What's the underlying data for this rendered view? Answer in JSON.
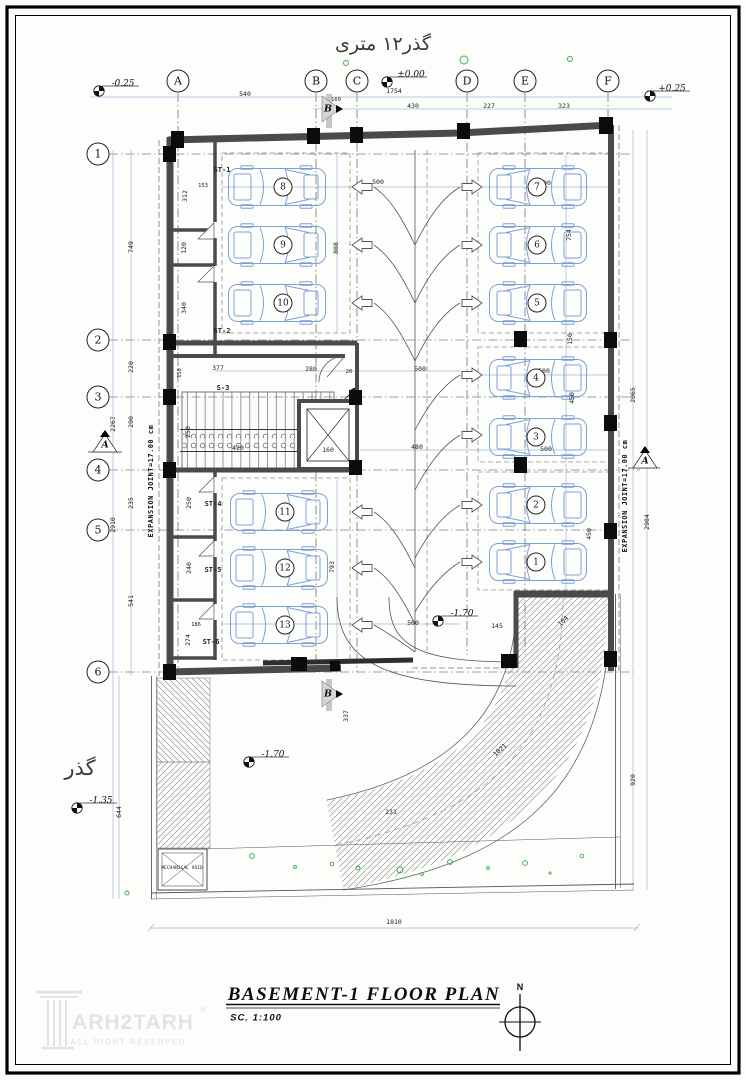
{
  "streets": {
    "top": "گذر۱۲ متری",
    "left": "گذر"
  },
  "grid": {
    "cols": [
      "A",
      "B",
      "C",
      "D",
      "E",
      "F"
    ],
    "rows": [
      "1",
      "2",
      "3",
      "4",
      "5",
      "6"
    ]
  },
  "levels": {
    "top_left": "-0.25",
    "top_center": "±0.00",
    "top_right": "+0.25",
    "aisle": "-1.70",
    "yard": "-1.70",
    "street": "-1.35"
  },
  "dims": {
    "top": [
      "540",
      "160",
      "1754",
      "430",
      "227",
      "323"
    ],
    "left": [
      "749",
      "220",
      "2267",
      "290",
      "235",
      "2910",
      "541",
      "644"
    ],
    "left_inner": [
      "153",
      "312",
      "120",
      "340",
      "150",
      "377",
      "250",
      "420",
      "160",
      "250",
      "240",
      "274",
      "186"
    ],
    "right": [
      "2065",
      "2984",
      "920"
    ],
    "right_inner": [
      "754",
      "150",
      "450",
      "450",
      "164",
      "145"
    ],
    "center": [
      "500",
      "808",
      "500",
      "480",
      "280",
      "20",
      "500",
      "500",
      "500",
      "793",
      "500",
      "337",
      "231",
      "1021"
    ],
    "bottom": "1810"
  },
  "rooms": {
    "st1": "ST-1",
    "st2": "ST-2",
    "s3": "S-3",
    "st4": "ST-4",
    "st5": "ST-5",
    "st6": "ST-6",
    "mech": "MECHANICAL VOID"
  },
  "cars": [
    "1",
    "2",
    "3",
    "4",
    "5",
    "6",
    "7",
    "8",
    "9",
    "10",
    "11",
    "12",
    "13"
  ],
  "notes": {
    "expansion": "EXPANSION JOINT=17.00 cm"
  },
  "sections": {
    "a": "A",
    "b": "B"
  },
  "titleblock": {
    "title": "BASEMENT-1  FLOOR  PLAN",
    "scale": "SC.  1:100",
    "north": "N"
  },
  "logo": {
    "brand": "ARH2TARH",
    "reg": "®",
    "sub": "ALL RIGHT RESERVED"
  },
  "colors": {
    "wall": "#4a4a4a",
    "column": "#0b0b0b",
    "dim_line": "#9fb8d8",
    "car_outline": "#7ba0d8",
    "plant": "#35a845",
    "hatch": "#777777"
  }
}
